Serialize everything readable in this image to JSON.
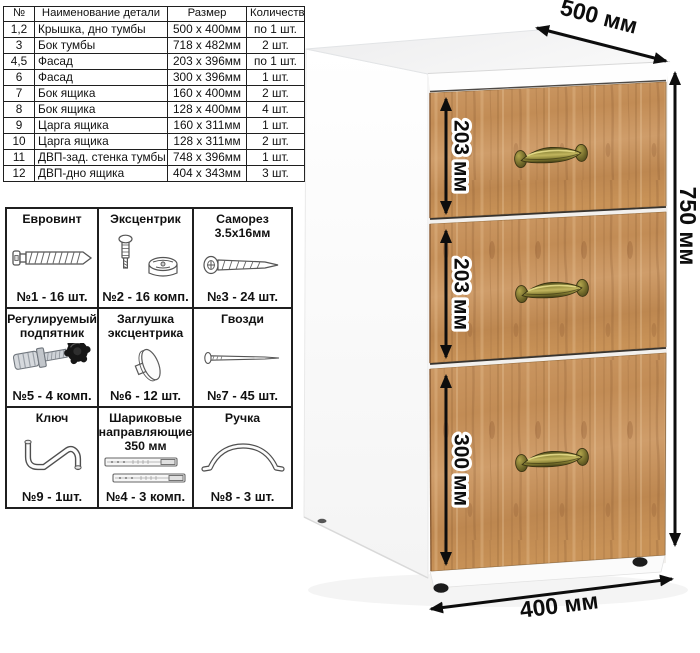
{
  "parts_table": {
    "headers": {
      "no": "№",
      "name": "Наименование детали",
      "size": "Размер",
      "qty": "Количество"
    },
    "rows": [
      {
        "no": "1,2",
        "name": "Крышка, дно тумбы",
        "size": "500 х 400мм",
        "qty": "по 1 шт."
      },
      {
        "no": "3",
        "name": "Бок тумбы",
        "size": "718 х 482мм",
        "qty": "2 шт."
      },
      {
        "no": "4,5",
        "name": "Фасад",
        "size": "203 х 396мм",
        "qty": "по 1 шт."
      },
      {
        "no": "6",
        "name": "Фасад",
        "size": "300 х 396мм",
        "qty": "1 шт."
      },
      {
        "no": "7",
        "name": "Бок ящика",
        "size": "160 х 400мм",
        "qty": "2 шт."
      },
      {
        "no": "8",
        "name": "Бок ящика",
        "size": "128 х 400мм",
        "qty": "4 шт."
      },
      {
        "no": "9",
        "name": "Царга ящика",
        "size": "160 х 311мм",
        "qty": "1 шт."
      },
      {
        "no": "10",
        "name": "Царга ящика",
        "size": "128 х 311мм",
        "qty": "2 шт."
      },
      {
        "no": "11",
        "name": "ДВП-зад. стенка тумбы",
        "size": "748 х 396мм",
        "qty": "1 шт."
      },
      {
        "no": "12",
        "name": "ДВП-дно ящика",
        "size": "404 х 343мм",
        "qty": "3 шт."
      }
    ]
  },
  "hardware": {
    "items": [
      {
        "title": "Евровинт",
        "count": "№1 - 16 шт.",
        "icon": "euro-screw-icon"
      },
      {
        "title": "Эксцентрик",
        "count": "№2 - 16 комп.",
        "icon": "eccentric-cam-icon"
      },
      {
        "title": "Саморез 3.5х16мм",
        "count": "№3 - 24 шт.",
        "icon": "small-screw-icon"
      },
      {
        "title": "Регулируемый подпятник",
        "count": "№5 - 4 комп.",
        "icon": "adjustable-foot-icon"
      },
      {
        "title": "Заглушка эксцентрика",
        "count": "№6 - 12 шт.",
        "icon": "cam-cap-icon"
      },
      {
        "title": "Гвозди",
        "count": "№7 - 45 шт.",
        "icon": "nail-icon"
      },
      {
        "title": "Ключ",
        "count": "№9 - 1шт.",
        "icon": "hex-key-icon"
      },
      {
        "title": "Шариковые направляющие 350 мм",
        "count": "№4 - 3 комп.",
        "icon": "ball-slides-icon"
      },
      {
        "title": "Ручка",
        "count": "№8 - 3 шт.",
        "icon": "pull-handle-icon"
      }
    ]
  },
  "cabinet": {
    "drawer_count": 3,
    "dimensions": {
      "depth": "500 мм",
      "height": "750 мм",
      "width": "400 мм",
      "drawer_top": "203 мм",
      "drawer_middle": "203 мм",
      "drawer_bottom": "300 мм"
    },
    "colors": {
      "wood": "#c28c55",
      "wood_dark": "#8a5c34",
      "handle_brass": "#8f883a",
      "body_white": "#ffffff",
      "dimension_text": "#0d0d0d"
    }
  }
}
